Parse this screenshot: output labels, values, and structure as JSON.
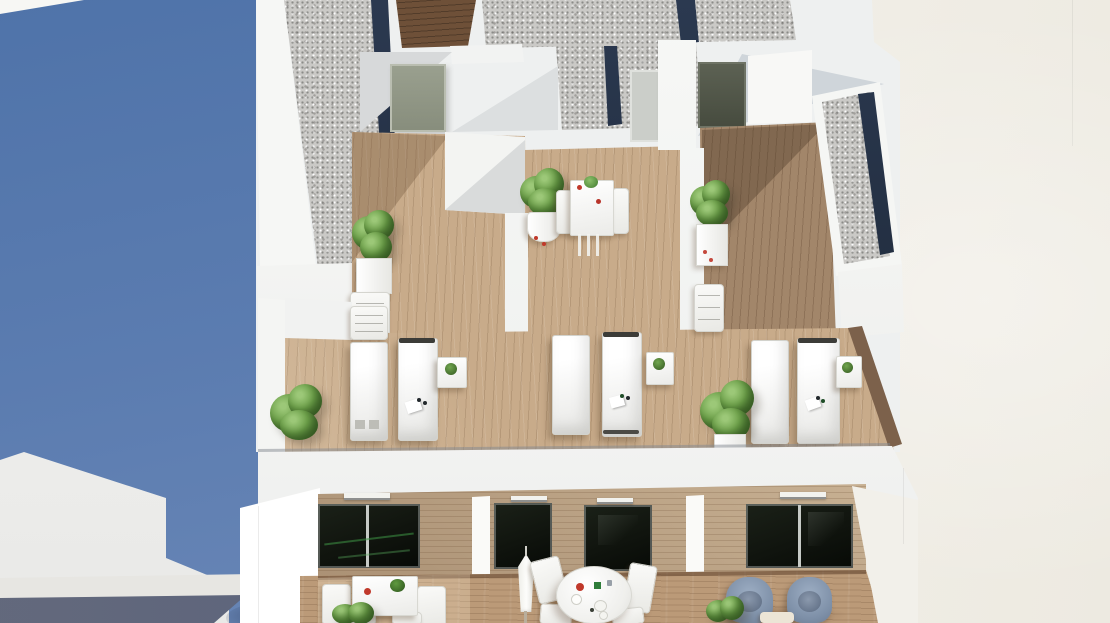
{
  "meta": {
    "type": "architectural-3d-render",
    "view": "aerial bird's-eye view of a three-unit residential building",
    "content_summary": "Rooftop terraces with wooden decks, gravel roof strips with navy insets, six white sun loungers, potted plants, bistro set, and lower-floor balconies with dining furniture; deep blue shadowed facade on the left, bright cream party wall on the right."
  },
  "palette": {
    "shadow_blue": "#5b7cb0",
    "shadow_blue_dark": "#4f73a9",
    "navy_inset": "#22304a",
    "gravel_gray": "#cac9c6",
    "white_wall": "#f4f5f3",
    "cream_wall": "#f2efe8",
    "deck_wood": "#c8ab8a",
    "deck_wood_dark": "#a2866a",
    "cladding_wood": "#d3bd9f",
    "roof_wood_dark": "#6e5038",
    "glass_dark": "#10140e",
    "glass_reflection_green": "#2e7d3e",
    "plant_green": "#6fa34b",
    "plant_green_dark": "#47702f",
    "armchair_blue_gray": "#7e90a8",
    "furniture_white": "#f7f7f4",
    "accent_red": "#c0392b",
    "accent_green": "#2f7d3a",
    "base_slab_gray": "#5d6375"
  },
  "environment": {
    "left_region": "blue shadowed neighboring facade with white lit corner walls",
    "bottom_left": "white corner wall, light gray ledge band, dark blue-gray base slab, corner pillar with soft shadow",
    "right_region": "large bright cream blank wall with faint vertical seam",
    "top_left_corner": "small white roof wedge"
  },
  "roof": {
    "gravel_strips": 4,
    "navy_edge_insets": 5,
    "dark_wood_panel": 1,
    "raised_gravel_planter_boxes": 2
  },
  "units": [
    {
      "name": "unit-1-left",
      "terrace_door": "gray-green single door",
      "upper_terrace": {
        "deck": "light wood",
        "planter": "white planter with green plant",
        "step_stool": "white ladder stool"
      },
      "lounger_bay": {
        "sun_loungers": 2,
        "side_table": "white cube with green plant",
        "potted_plant": 1,
        "folded_chairs": 1,
        "lounger_items": [
          "white towel",
          "dark accessories"
        ]
      },
      "balcony": {
        "window": "dark glass slider, 2 panes, green reflections",
        "vent": 1,
        "furniture": "square white dining table with red and green tableware, 4 white chairs",
        "plant": "green shrub"
      }
    },
    {
      "name": "unit-2-middle",
      "terrace_door": "light gray single door",
      "upper_terrace": {
        "deck": "light wood",
        "planter": "tall white pot with green plant and red flowers",
        "bistro_set": "white square table with 2 white chairs, red and green items"
      },
      "lounger_bay": {
        "sun_loungers": 2,
        "side_table": "white cube with green plant",
        "lounger_items": [
          "white towel",
          "dark accessories"
        ]
      },
      "balcony": {
        "windows": 2,
        "vents": 2,
        "furniture": "closed white parasol, round white table with red, green and gray tableware, 4 white chairs"
      }
    },
    {
      "name": "unit-3-right",
      "terrace_door": "dark gray single door",
      "upper_terrace": {
        "deck": "shaded wood",
        "planter": "white box planter with green plant and red flowers"
      },
      "lounger_bay": {
        "sun_loungers": 2,
        "side_table": "white cube with green plant",
        "potted_plant": 1,
        "folded_chairs": 1
      },
      "balcony": {
        "window": "dark glass slider, 2 panes",
        "vent": 1,
        "furniture": "2 blue-gray armchairs, low cream side table",
        "plant": "green shrub"
      }
    }
  ]
}
